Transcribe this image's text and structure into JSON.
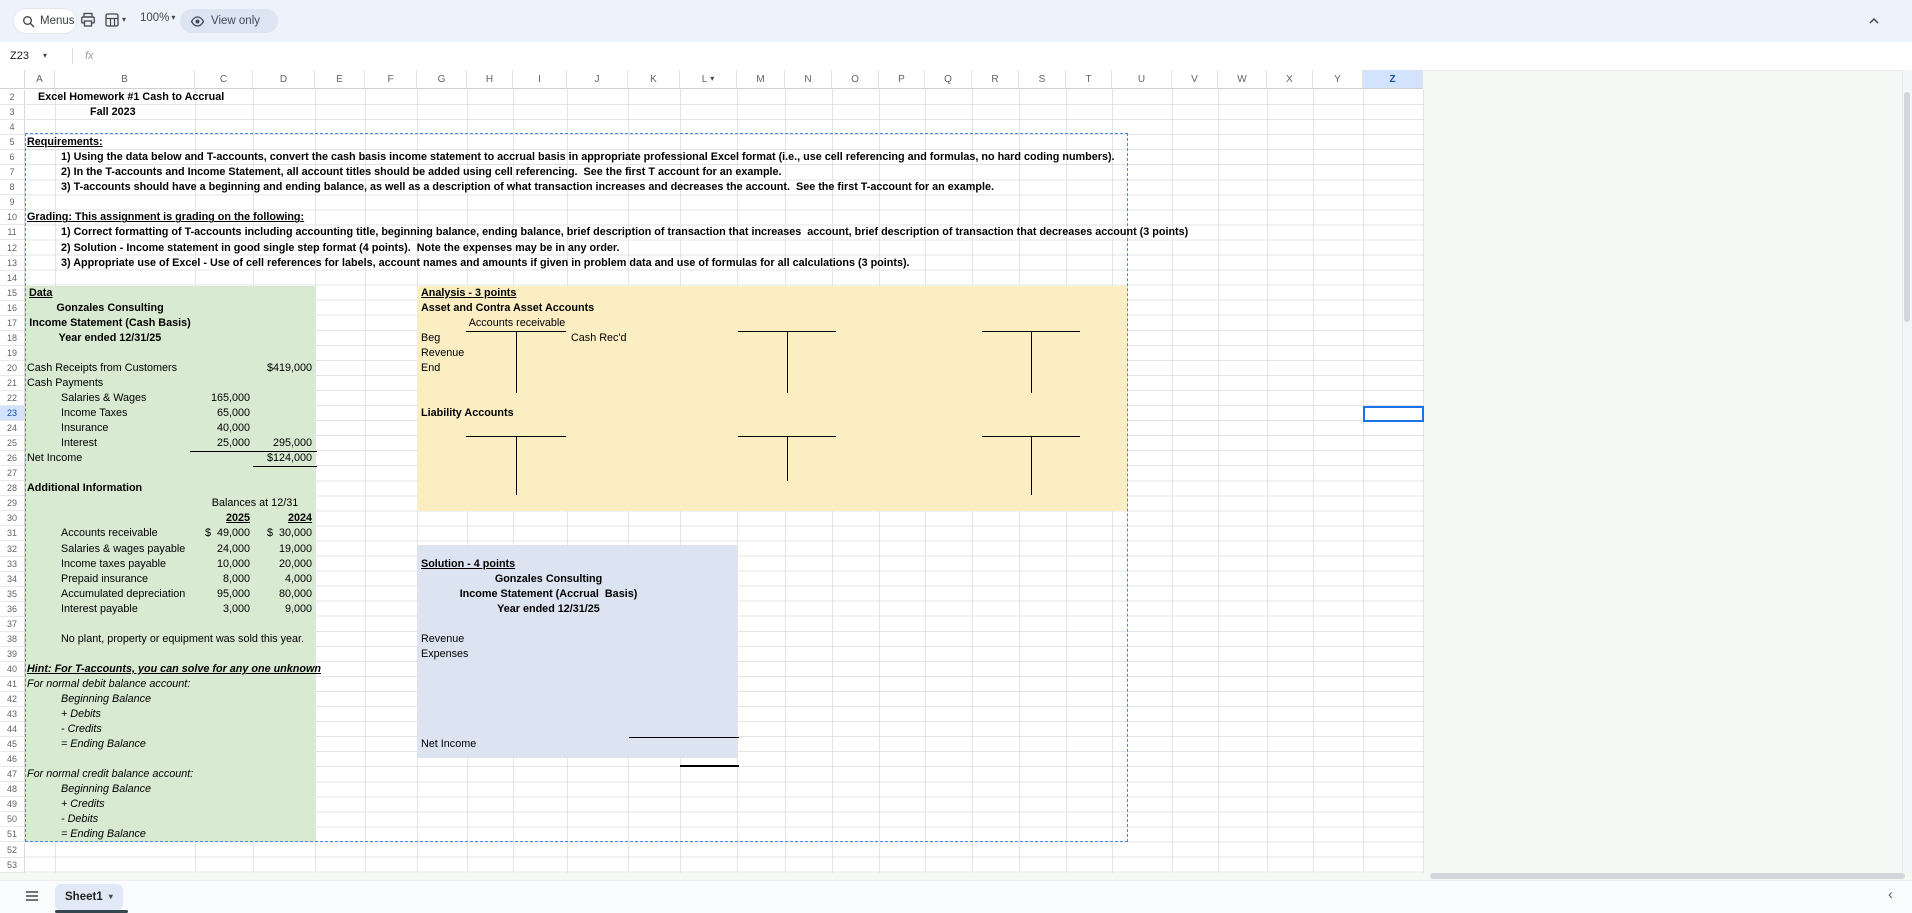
{
  "toolbar": {
    "menus_label": "Menus",
    "zoom_level": "100%",
    "view_only_label": "View only"
  },
  "formula_bar": {
    "cell_ref": "Z23",
    "fx_label": "fx"
  },
  "icons": {
    "caret_down": "▾",
    "chevron_left": "‹"
  },
  "grid": {
    "selected_cell": "Z23",
    "selected_row": 23,
    "row_start": 2,
    "row_end": 53,
    "columns": [
      {
        "label": "A"
      },
      {
        "label": "B"
      },
      {
        "label": "C"
      },
      {
        "label": "D"
      },
      {
        "label": "E"
      },
      {
        "label": "F"
      },
      {
        "label": "G"
      },
      {
        "label": "H"
      },
      {
        "label": "I"
      },
      {
        "label": "J"
      },
      {
        "label": "K"
      },
      {
        "label": "L",
        "has_caret": true
      },
      {
        "label": "M"
      },
      {
        "label": "N"
      },
      {
        "label": "O"
      },
      {
        "label": "P"
      },
      {
        "label": "Q"
      },
      {
        "label": "R"
      },
      {
        "label": "S"
      },
      {
        "label": "T"
      },
      {
        "label": "U"
      },
      {
        "label": "V"
      },
      {
        "label": "W"
      },
      {
        "label": "X"
      },
      {
        "label": "Y"
      },
      {
        "label": "Z",
        "selected": true
      }
    ]
  },
  "colors": {
    "data_region_green": "#d9ead3",
    "analysis_region_yellow": "#fbeec3",
    "solution_region_blue": "#dce3f1",
    "marquee_blue": "#4a86e8",
    "selection_blue": "#1a73e8",
    "header_highlight": "#d3e3fd"
  },
  "cells": [
    {
      "c": "A",
      "r": 2,
      "t": "Excel Homework #1 Cash to Accrual",
      "b": 1,
      "ind": 13
    },
    {
      "c": "A",
      "r": 3,
      "t": "Fall 2023",
      "b": 1,
      "ind": 65
    },
    {
      "c": "A",
      "r": 5,
      "t": "Requirements:",
      "b": 1,
      "u": 1
    },
    {
      "c": "B",
      "r": 6,
      "t": "1) Using the data below and T-accounts, convert the cash basis income statement to accrual basis in appropriate professional Excel format (i.e., use cell referencing and formulas, no hard coding numbers).",
      "b": 1,
      "ind": 6
    },
    {
      "c": "B",
      "r": 7,
      "t": "2) In the T-accounts and Income Statement, all account titles should be added using cell referencing.  See the first T account for an example.",
      "b": 1,
      "ind": 6
    },
    {
      "c": "B",
      "r": 8,
      "t": "3) T-accounts should have a beginning and ending balance, as well as a description of what transaction increases and decreases the account.  See the first T-account for an example.",
      "b": 1,
      "ind": 6
    },
    {
      "c": "A",
      "r": 10,
      "t": "Grading: This assignment is grading on the following:",
      "b": 1,
      "u": 1
    },
    {
      "c": "B",
      "r": 11,
      "t": "1) Correct formatting of T-accounts including accounting title, beginning balance, ending balance, brief description of transaction that increases  account, brief description of transaction that decreases account (3 points)",
      "b": 1,
      "ind": 6
    },
    {
      "c": "B",
      "r": 12,
      "t": "2) Solution - Income statement in good single step format (4 points).  Note the expenses may be in any order.",
      "b": 1,
      "ind": 6
    },
    {
      "c": "B",
      "r": 13,
      "t": "3) Appropriate use of Excel - Use of cell references for labels, account names and amounts if given in problem data and use of formulas for all calculations (3 points).",
      "b": 1,
      "ind": 6
    },
    {
      "c": "A",
      "r": 15,
      "t": "Data",
      "b": 1,
      "u": 1,
      "ind": 4
    },
    {
      "span": "A:B",
      "r": 16,
      "t": "Gonzales Consulting",
      "b": 1,
      "al": "center"
    },
    {
      "span": "A:B",
      "r": 17,
      "t": "Income Statement (Cash Basis)",
      "b": 1,
      "al": "center"
    },
    {
      "span": "A:B",
      "r": 18,
      "t": "Year ended 12/31/25",
      "b": 1,
      "al": "center"
    },
    {
      "c": "A",
      "r": 20,
      "t": "Cash Receipts from Customers"
    },
    {
      "c": "D",
      "r": 20,
      "t": "$419,000",
      "al": "right"
    },
    {
      "c": "A",
      "r": 21,
      "t": "Cash Payments"
    },
    {
      "c": "B",
      "r": 22,
      "t": "Salaries & Wages",
      "ind": 6
    },
    {
      "c": "C",
      "r": 22,
      "t": "165,000",
      "al": "right"
    },
    {
      "c": "B",
      "r": 23,
      "t": "Income Taxes",
      "ind": 6
    },
    {
      "c": "C",
      "r": 23,
      "t": "65,000",
      "al": "right"
    },
    {
      "c": "B",
      "r": 24,
      "t": "Insurance",
      "ind": 6
    },
    {
      "c": "C",
      "r": 24,
      "t": "40,000",
      "al": "right"
    },
    {
      "c": "B",
      "r": 25,
      "t": "Interest",
      "ind": 6
    },
    {
      "c": "C",
      "r": 25,
      "t": "25,000",
      "al": "right"
    },
    {
      "c": "D",
      "r": 25,
      "t": "295,000",
      "al": "right"
    },
    {
      "c": "A",
      "r": 26,
      "t": "Net Income"
    },
    {
      "c": "D",
      "r": 26,
      "t": "$124,000",
      "al": "right"
    },
    {
      "c": "A",
      "r": 28,
      "t": "Additional Information",
      "b": 1
    },
    {
      "span": "C:D",
      "r": 29,
      "t": "Balances at 12/31",
      "al": "center"
    },
    {
      "c": "C",
      "r": 30,
      "t": "2025",
      "b": 1,
      "u": 1,
      "al": "right"
    },
    {
      "c": "D",
      "r": 30,
      "t": "2024",
      "b": 1,
      "u": 1,
      "al": "right"
    },
    {
      "c": "B",
      "r": 31,
      "t": "Accounts receivable",
      "ind": 6
    },
    {
      "c": "C",
      "r": 31,
      "t": "$  49,000",
      "al": "right"
    },
    {
      "c": "D",
      "r": 31,
      "t": "$  30,000",
      "al": "right"
    },
    {
      "c": "B",
      "r": 32,
      "t": "Salaries & wages payable",
      "ind": 6
    },
    {
      "c": "C",
      "r": 32,
      "t": "24,000",
      "al": "right"
    },
    {
      "c": "D",
      "r": 32,
      "t": "19,000",
      "al": "right"
    },
    {
      "c": "B",
      "r": 33,
      "t": "Income taxes payable",
      "ind": 6
    },
    {
      "c": "C",
      "r": 33,
      "t": "10,000",
      "al": "right"
    },
    {
      "c": "D",
      "r": 33,
      "t": "20,000",
      "al": "right"
    },
    {
      "c": "B",
      "r": 34,
      "t": "Prepaid insurance",
      "ind": 6
    },
    {
      "c": "C",
      "r": 34,
      "t": "8,000",
      "al": "right"
    },
    {
      "c": "D",
      "r": 34,
      "t": "4,000",
      "al": "right"
    },
    {
      "c": "B",
      "r": 35,
      "t": "Accumulated depreciation",
      "ind": 6
    },
    {
      "c": "C",
      "r": 35,
      "t": "95,000",
      "al": "right"
    },
    {
      "c": "D",
      "r": 35,
      "t": "80,000",
      "al": "right"
    },
    {
      "c": "B",
      "r": 36,
      "t": "Interest payable",
      "ind": 6
    },
    {
      "c": "C",
      "r": 36,
      "t": "3,000",
      "al": "right"
    },
    {
      "c": "D",
      "r": 36,
      "t": "9,000",
      "al": "right"
    },
    {
      "c": "B",
      "r": 38,
      "t": "No plant, property or equipment was sold this year.",
      "ind": 6
    },
    {
      "c": "A",
      "r": 40,
      "t": "Hint: For T-accounts, you can solve for any one unknown",
      "b": 1,
      "i": 1,
      "u": 1
    },
    {
      "c": "A",
      "r": 41,
      "t": "For normal debit balance account:",
      "i": 1
    },
    {
      "c": "B",
      "r": 42,
      "t": "Beginning Balance",
      "i": 1,
      "ind": 6
    },
    {
      "c": "B",
      "r": 43,
      "t": "+ Debits",
      "i": 1,
      "ind": 6
    },
    {
      "c": "B",
      "r": 44,
      "t": "- Credits",
      "i": 1,
      "ind": 6
    },
    {
      "c": "B",
      "r": 45,
      "t": "= Ending Balance",
      "i": 1,
      "ind": 6
    },
    {
      "c": "A",
      "r": 47,
      "t": "For normal credit balance account:",
      "i": 1
    },
    {
      "c": "B",
      "r": 48,
      "t": "Beginning Balance",
      "i": 1,
      "ind": 6
    },
    {
      "c": "B",
      "r": 49,
      "t": "+ Credits",
      "i": 1,
      "ind": 6
    },
    {
      "c": "B",
      "r": 50,
      "t": "- Debits",
      "i": 1,
      "ind": 6
    },
    {
      "c": "B",
      "r": 51,
      "t": "= Ending Balance",
      "i": 1,
      "ind": 6
    },
    {
      "c": "G",
      "r": 15,
      "t": "Analysis - 3 points",
      "b": 1,
      "u": 1,
      "ind": 4
    },
    {
      "c": "G",
      "r": 16,
      "t": "Asset and Contra Asset Accounts",
      "b": 1,
      "ind": 4
    },
    {
      "span": "H:I",
      "r": 17,
      "t": "Accounts receivable",
      "al": "center"
    },
    {
      "c": "G",
      "r": 18,
      "t": "Beg",
      "ind": 4
    },
    {
      "c": "J",
      "r": 18,
      "t": "Cash Rec'd",
      "ind": 4
    },
    {
      "c": "G",
      "r": 19,
      "t": "Revenue",
      "ind": 4
    },
    {
      "c": "G",
      "r": 20,
      "t": "End",
      "ind": 4
    },
    {
      "c": "G",
      "r": 23,
      "t": "Liability Accounts",
      "b": 1,
      "ind": 4
    },
    {
      "c": "G",
      "r": 33,
      "t": "Solution - 4 points",
      "b": 1,
      "u": 1,
      "ind": 4
    },
    {
      "span": "G:K",
      "r": 34,
      "t": "Gonzales Consulting",
      "b": 1,
      "al": "center"
    },
    {
      "span": "G:K",
      "r": 35,
      "t": "Income Statement (Accrual  Basis)",
      "b": 1,
      "al": "center"
    },
    {
      "span": "G:K",
      "r": 36,
      "t": "Year ended 12/31/25",
      "b": 1,
      "al": "center"
    },
    {
      "c": "G",
      "r": 38,
      "t": "Revenue",
      "ind": 4
    },
    {
      "c": "G",
      "r": 39,
      "t": "Expenses",
      "ind": 4
    },
    {
      "c": "G",
      "r": 45,
      "t": "Net Income",
      "ind": 4
    }
  ],
  "tab_bar": {
    "active_sheet": "Sheet1"
  }
}
